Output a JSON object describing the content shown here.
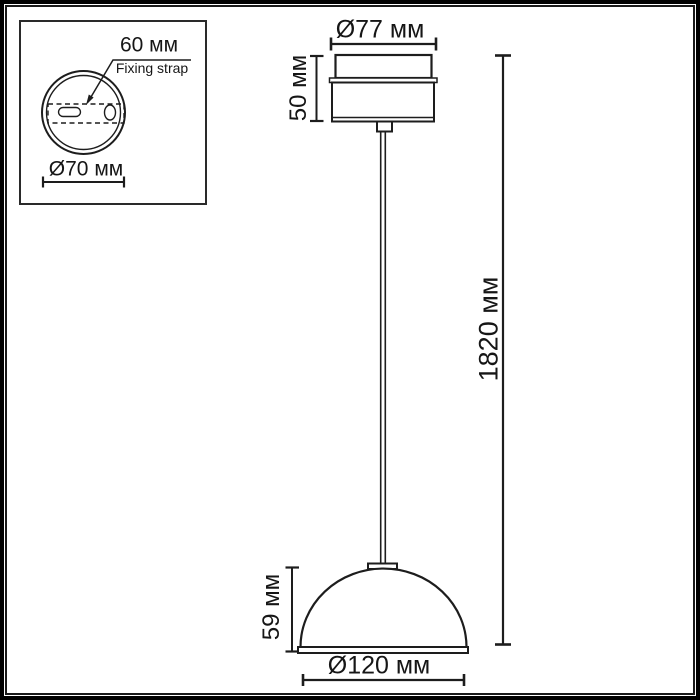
{
  "colors": {
    "line": "#1d1d1d",
    "text": "#161616",
    "background": "#ffffff"
  },
  "inset_view": {
    "strap_length_label": "60 мм",
    "strap_name_label": "Fixing strap",
    "canopy_diameter_label": "Ø70 мм"
  },
  "front_view": {
    "canopy_diameter_label": "Ø77 мм",
    "canopy_height_label": "50 мм",
    "overall_height_label": "1820 мм",
    "shade_height_label": "59 мм",
    "shade_diameter_label": "Ø120 мм"
  }
}
